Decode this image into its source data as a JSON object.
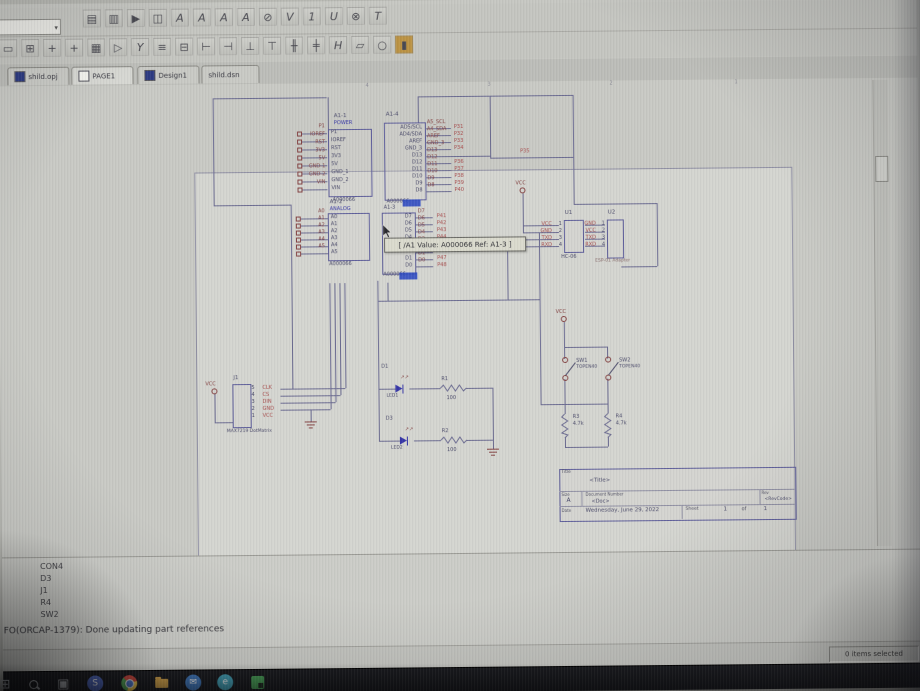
{
  "app_tabs": [
    {
      "label": "shild.opj",
      "icon": "project-icon"
    },
    {
      "label": "PAGE1",
      "icon": "page-icon"
    },
    {
      "label": "Design1",
      "icon": "design-icon"
    },
    {
      "label": "shild.dsn",
      "icon": ""
    }
  ],
  "toolbar1": {
    "combobox_value": "",
    "icons": [
      {
        "name": "new-icon",
        "glyph": "▤"
      },
      {
        "name": "open-icon",
        "glyph": "▥"
      },
      {
        "name": "run-icon",
        "glyph": "▶"
      },
      {
        "name": "window-icon",
        "glyph": "◫"
      },
      {
        "name": "annotate-icon",
        "glyph": "A"
      },
      {
        "name": "backannotate-icon",
        "glyph": "A"
      },
      {
        "name": "update-properties-icon",
        "glyph": "A"
      },
      {
        "name": "drc-icon",
        "glyph": "A"
      },
      {
        "name": "no-drc-icon",
        "glyph": "⊘"
      },
      {
        "name": "netlist-icon",
        "glyph": "V"
      },
      {
        "name": "cross-reference-icon",
        "glyph": "1"
      },
      {
        "name": "bom-icon",
        "glyph": "U"
      },
      {
        "name": "snap-grid-icon",
        "glyph": "⊗"
      },
      {
        "name": "project-manager-icon",
        "glyph": "T"
      }
    ]
  },
  "toolbar2": {
    "icons": [
      {
        "name": "select-icon",
        "glyph": "▭"
      },
      {
        "name": "place-part-icon",
        "glyph": "⊞"
      },
      {
        "name": "place-wire-icon",
        "glyph": "+"
      },
      {
        "name": "place-bus-icon",
        "glyph": "+"
      },
      {
        "name": "place-junction-icon",
        "glyph": "▦"
      },
      {
        "name": "place-net-alias-icon",
        "glyph": "▷"
      },
      {
        "name": "place-power-icon",
        "glyph": "Y"
      },
      {
        "name": "place-ground-icon",
        "glyph": "≡"
      },
      {
        "name": "hierarchical-block-icon",
        "glyph": "⊟"
      },
      {
        "name": "hierarchical-port-icon",
        "glyph": "⊢"
      },
      {
        "name": "hierarchical-pin-icon",
        "glyph": "⊣"
      },
      {
        "name": "off-page-connector-icon",
        "glyph": "⊥"
      },
      {
        "name": "no-connect-icon",
        "glyph": "⊤"
      },
      {
        "name": "place-line-icon",
        "glyph": "╫"
      },
      {
        "name": "place-polyline-icon",
        "glyph": "╪"
      },
      {
        "name": "place-rectangle-icon",
        "glyph": "H"
      },
      {
        "name": "place-ellipse-icon",
        "glyph": "▱"
      },
      {
        "name": "place-arc-icon",
        "glyph": "○"
      },
      {
        "name": "place-text-icon",
        "glyph": "▮",
        "accent": "#c09238"
      }
    ]
  },
  "schematic": {
    "zones": [
      "4",
      "3",
      "2",
      "1"
    ],
    "power_net": "VCC",
    "parts": {
      "a1_1": {
        "ref": "A1-1",
        "section": "POWER",
        "value": "A000066",
        "pins": [
          "P1",
          "IOREF",
          "RST",
          "3V3",
          "5V",
          "GND_1",
          "GND_2",
          "VIN"
        ],
        "labels": [
          "P1",
          "IOREF",
          "RST",
          "3V3",
          "5V",
          "GND-1",
          "GND-2",
          "VIN"
        ]
      },
      "a1_4": {
        "ref": "A1-4",
        "value": "A000066",
        "pins": [
          "AD5/SCL",
          "AD4/SDA",
          "AREF",
          "GND_3",
          "D13",
          "D12",
          "D11",
          "D10",
          "D9",
          "D8"
        ],
        "labels": [
          "A5_SCL",
          "A4_SDA",
          "AREF",
          "GND_3",
          "D13",
          "D12",
          "D11",
          "D10",
          "D9",
          "D8"
        ],
        "nets": [
          "P31",
          "P32",
          "P33",
          "P34",
          "P35",
          "P36",
          "P37",
          "P38",
          "P39",
          "P40"
        ]
      },
      "a1_2": {
        "ref": "A1-2",
        "section": "ANALOG",
        "value": "A000066",
        "pins": [
          "A0",
          "A1",
          "A2",
          "A3",
          "A4",
          "A5"
        ],
        "labels": [
          "A0",
          "A1",
          "A2",
          "A3",
          "A4",
          "A5"
        ]
      },
      "a1_3": {
        "ref": "A1-3",
        "value": "A000066",
        "pins": [
          "D7",
          "D6",
          "D5",
          "D4",
          "D3",
          "D2",
          "D1",
          "D0"
        ],
        "labels": [
          "D7",
          "D6",
          "D5",
          "D4",
          "D3",
          "D2",
          "D1",
          "D0"
        ],
        "nets": [
          "P41",
          "P42",
          "P43",
          "P44",
          "P45",
          "P46",
          "P47",
          "P48"
        ]
      },
      "hc06": {
        "ref": "U1",
        "value": "HC-06",
        "pin_numbers": [
          "1",
          "2",
          "3",
          "4"
        ],
        "nets": [
          "VCC",
          "GND",
          "TXD",
          "RXD"
        ]
      },
      "esp01": {
        "ref": "U2",
        "value": "ESP-01 Adapter",
        "pin_numbers": [
          "1",
          "2",
          "3",
          "4"
        ],
        "nets": [
          "GND",
          "VCC",
          "TXD",
          "RXD"
        ]
      },
      "max7219": {
        "ref": "J1",
        "value": "MAX7219 DotMatrix",
        "pin_numbers": [
          "5",
          "4",
          "3",
          "2",
          "1"
        ],
        "nets": [
          "CLK",
          "CS",
          "DIN",
          "GND",
          "VCC"
        ]
      },
      "led1": {
        "ref": "D1",
        "value": "LED1"
      },
      "r1": {
        "ref": "R1",
        "value": "100"
      },
      "led2": {
        "ref": "D3",
        "value": "LED2"
      },
      "r2": {
        "ref": "R2",
        "value": "100"
      },
      "sw1": {
        "ref": "SW1",
        "value": "TOPEN40"
      },
      "sw2": {
        "ref": "SW2",
        "value": "TOPEN40"
      },
      "r3": {
        "ref": "R3",
        "value": "4.7k"
      },
      "r4": {
        "ref": "R4",
        "value": "4.7k"
      }
    },
    "tooltip": "[ /A1 Value: A000066 Ref: A1-3 ]",
    "title_block": {
      "title_label": "Title",
      "title": "<Title>",
      "size_label": "Size",
      "size": "A",
      "doc_label": "Document Number",
      "doc": "<Doc>",
      "rev_label": "Rev",
      "rev": "<RevCode>",
      "date_label": "Date",
      "date": "Wednesday, June 29, 2022",
      "sheet_label": "Sheet",
      "sheet": "1",
      "of_label": "of",
      "total": "1"
    }
  },
  "session_log": {
    "items": [
      "CON4",
      "D3",
      "J1",
      "R4",
      "SW2"
    ],
    "message": "FO(ORCAP-1379): Done updating part references"
  },
  "status_bar": {
    "selection": "0 items selected"
  },
  "taskbar": {
    "icons": [
      {
        "name": "start-icon",
        "kind": "glyph",
        "glyph": "⊞",
        "fg": "#c6cad2"
      },
      {
        "name": "search-icon",
        "kind": "search"
      },
      {
        "name": "task-view-icon",
        "kind": "glyph",
        "glyph": "▣",
        "fg": "#b4b8be"
      },
      {
        "name": "teams-icon",
        "kind": "circle",
        "bg": "#4a66c8",
        "glyph": "S",
        "fg": "#ffffff"
      },
      {
        "name": "chrome-icon",
        "kind": "chrome"
      },
      {
        "name": "files-icon",
        "kind": "folder",
        "bg": "#d9a33c"
      },
      {
        "name": "mail-icon",
        "kind": "circle",
        "bg": "#3a7ac8",
        "glyph": "✉",
        "fg": "#ffffff"
      },
      {
        "name": "edge-icon",
        "kind": "circle",
        "bg": "#38a2ba",
        "glyph": "e",
        "fg": "#ffffff"
      },
      {
        "name": "capture-icon",
        "kind": "capture",
        "bg": "#3f9e4f"
      }
    ]
  },
  "colors": {
    "wire": "#6b6b96",
    "component": "#5d5da2",
    "net_red": "#b04848",
    "label_maroon": "#8a4040",
    "value_blue": "#3535b5",
    "highlight": "#2b4bd0"
  }
}
